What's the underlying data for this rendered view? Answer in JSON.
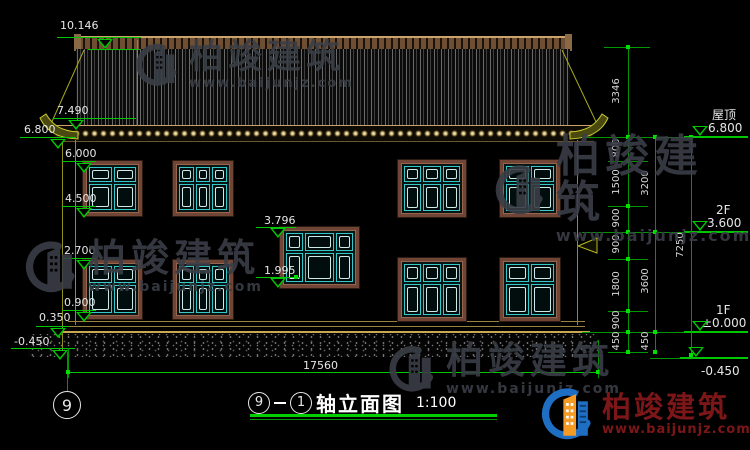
{
  "watermark": {
    "brand": "柏竣建筑",
    "url": "www.baijunjz.com"
  },
  "footer_logo": {
    "brand": "柏竣建筑",
    "url": "www.baijunjz.com"
  },
  "levels_left": {
    "ridge": "10.146",
    "eave_top": "7.490",
    "eave": "6.800",
    "win2_top": "6.000",
    "win2_sill": "4.500",
    "win1_top": "2.700",
    "win1_sill": "0.900",
    "plinth": "0.350",
    "ground": "-0.450"
  },
  "levels_mid": {
    "top": "3.796",
    "sill": "1.995"
  },
  "levels_right": [
    {
      "label": "屋顶",
      "value": "6.800"
    },
    {
      "label": "2F",
      "value": "3.600"
    },
    {
      "label": "1F",
      "value": "±0.000"
    },
    {
      "label": "",
      "value": "-0.450"
    }
  ],
  "dims_right": {
    "chain1": [
      "3346",
      "800",
      "1500",
      "900",
      "900",
      "1800",
      "900",
      "450"
    ],
    "chain2": [
      "3200",
      "3600",
      "450"
    ],
    "chain3": [
      "7250"
    ]
  },
  "dim_bottom": "17560",
  "axis": {
    "bubble": "9"
  },
  "title": {
    "axis_start": "9",
    "axis_end": "1",
    "name": "轴立面图",
    "scale": "1:100"
  },
  "colors": {
    "dim_green": "#00c800",
    "cad_olive": "#8f8f1a",
    "frame_brown": "#714536",
    "glass_cyan": "#35c8c8",
    "watermark_gray": "#3a3e46",
    "logo_blue": "#1e6fc4",
    "logo_orange": "#f59a23",
    "logo_red": "#7d1618"
  }
}
